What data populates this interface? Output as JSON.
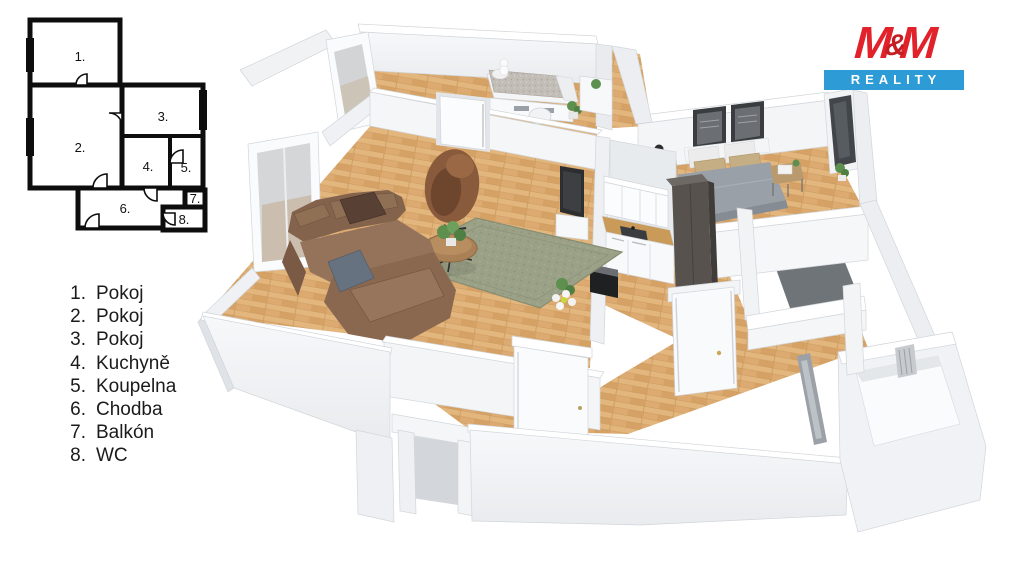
{
  "schematic": {
    "rooms": [
      {
        "num": "1."
      },
      {
        "num": "2."
      },
      {
        "num": "3."
      },
      {
        "num": "4."
      },
      {
        "num": "5."
      },
      {
        "num": "6."
      },
      {
        "num": "7."
      },
      {
        "num": "8."
      }
    ]
  },
  "legend": {
    "items": [
      {
        "num": "1.",
        "label": "Pokoj"
      },
      {
        "num": "2.",
        "label": "Pokoj"
      },
      {
        "num": "3.",
        "label": "Pokoj"
      },
      {
        "num": "4.",
        "label": "Kuchyně"
      },
      {
        "num": "5.",
        "label": "Koupelna"
      },
      {
        "num": "6.",
        "label": "Chodba"
      },
      {
        "num": "7.",
        "label": "Balkón"
      },
      {
        "num": "8.",
        "label": "WC"
      }
    ]
  },
  "logo": {
    "brand_parts": [
      "M",
      "&",
      "M"
    ],
    "sub": "REALITY",
    "brand_color": "#e1222a",
    "bar_color": "#2d9bd5"
  },
  "palette": {
    "wall_lit": "#f5f6f8",
    "wall_mid": "#eceef1",
    "wall_shade": "#e0e3e7",
    "floor_wood": "#ddab71",
    "floor_tile_grey": "#6f7478",
    "sofa_brown": "#8a6750",
    "rug_sage": "#9ba186",
    "bed_grey": "#9aa0a7",
    "wardrobe_dark": "#57524e",
    "counter_wood": "#c99a58"
  }
}
